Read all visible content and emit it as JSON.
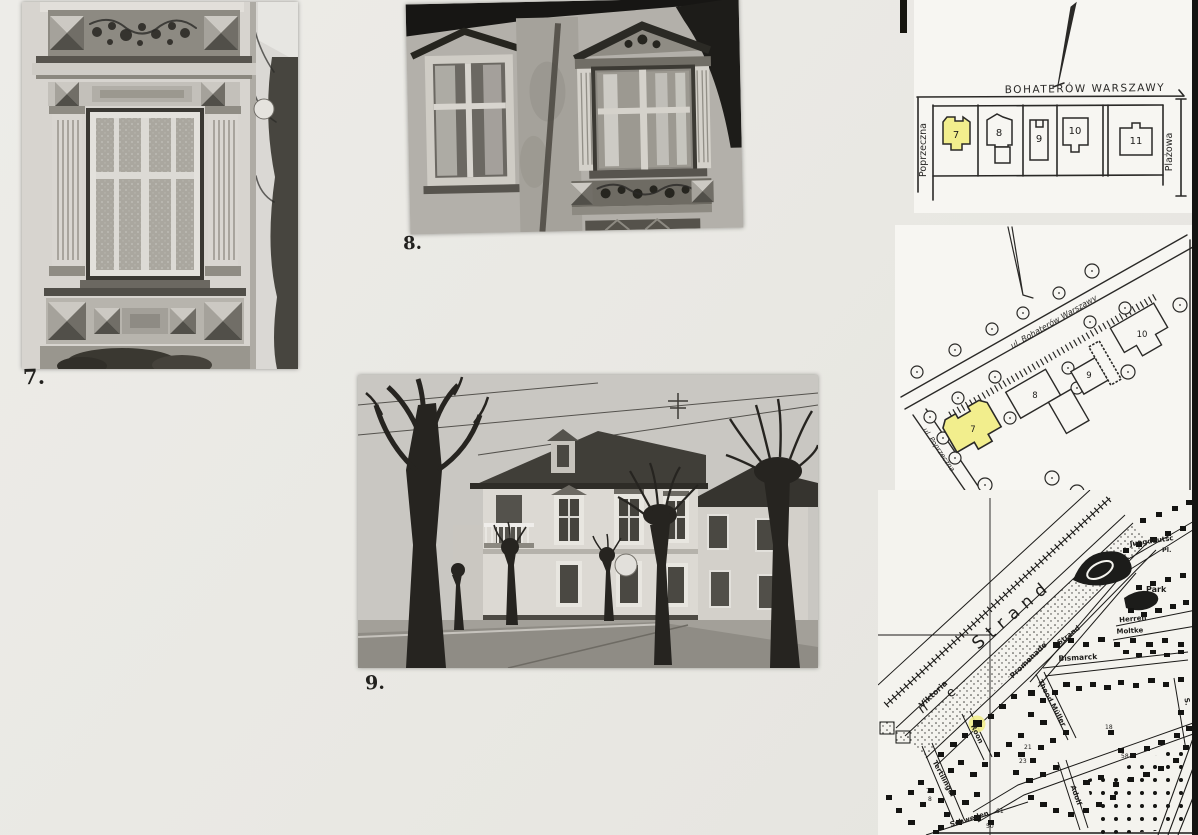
{
  "page": {
    "photo_labels": {
      "p7": "7.",
      "p8": "8.",
      "p9": "9."
    }
  },
  "sketch_map": {
    "street_top": "BOHATERÓW WARSZAWY",
    "street_left": "Poprzeczna",
    "street_right": "Plażowa",
    "plot_numbers": [
      "7",
      "8",
      "9",
      "10",
      "11"
    ],
    "highlighted_plot": "7",
    "highlight_color": "#f2ee8d"
  },
  "site_plan": {
    "street_main": "ul. Bohaterów Warszawy",
    "street_side": "ul. Poprzeczna",
    "building_numbers": [
      "7",
      "8",
      "9",
      "10"
    ],
    "highlighted_building": "7",
    "highlight_color": "#f2ee8d"
  },
  "city_map": {
    "large_labels": {
      "beach": "Strand",
      "dune_n": "n",
      "dune_e": "e"
    },
    "street_labels": {
      "viktoria": "Viktoria",
      "promenade": "Promenade",
      "bismarck": "Bismarck",
      "theod_mueller": "Theod.Müller",
      "roon": "Roon",
      "moltke": "Moltke",
      "herren": "Herren",
      "schweden": "Schweden",
      "adolf": "Adolf",
      "strand_street": "Strand",
      "tertilinger": "Tertilinger",
      "edge_s": "S."
    },
    "area_labels": {
      "jungdeutsch": "Jungdeutsc",
      "platz": "Pl.",
      "park": "Park"
    },
    "plot_numbers": [
      "21",
      "23",
      "58",
      "61",
      "50",
      "7",
      "8",
      "18"
    ],
    "highlight_color": "#f2ee8d"
  }
}
